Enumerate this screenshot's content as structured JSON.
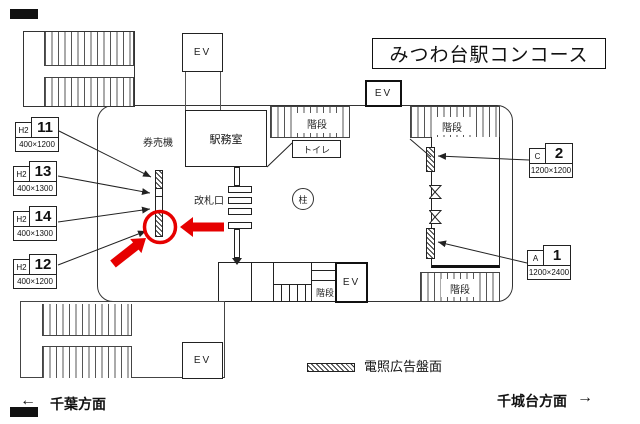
{
  "title": "みつわ台駅コンコース",
  "colors": {
    "line": "#222222",
    "red": "#e60000"
  },
  "labels": {
    "elevator": "EV",
    "stairs": "階段",
    "office": "駅務室",
    "ticket_machines": "券売機",
    "toilet": "トイレ",
    "ticket_gate": "改札口",
    "pillar": "柱"
  },
  "signs": {
    "left": [
      {
        "prefix": "H2",
        "number": "11",
        "size": "400×1200"
      },
      {
        "prefix": "H2",
        "number": "13",
        "size": "400×1300"
      },
      {
        "prefix": "H2",
        "number": "14",
        "size": "400×1300"
      },
      {
        "prefix": "H2",
        "number": "12",
        "size": "400×1200"
      }
    ],
    "right": [
      {
        "prefix": "C",
        "number": "2",
        "size": "1200×1200"
      },
      {
        "prefix": "A",
        "number": "1",
        "size": "1200×2400"
      }
    ]
  },
  "legend": {
    "label": "電照広告盤面"
  },
  "directions": {
    "left_arrow": "←",
    "left": "千葉方面",
    "right": "千城台方面",
    "right_arrow": "→"
  }
}
